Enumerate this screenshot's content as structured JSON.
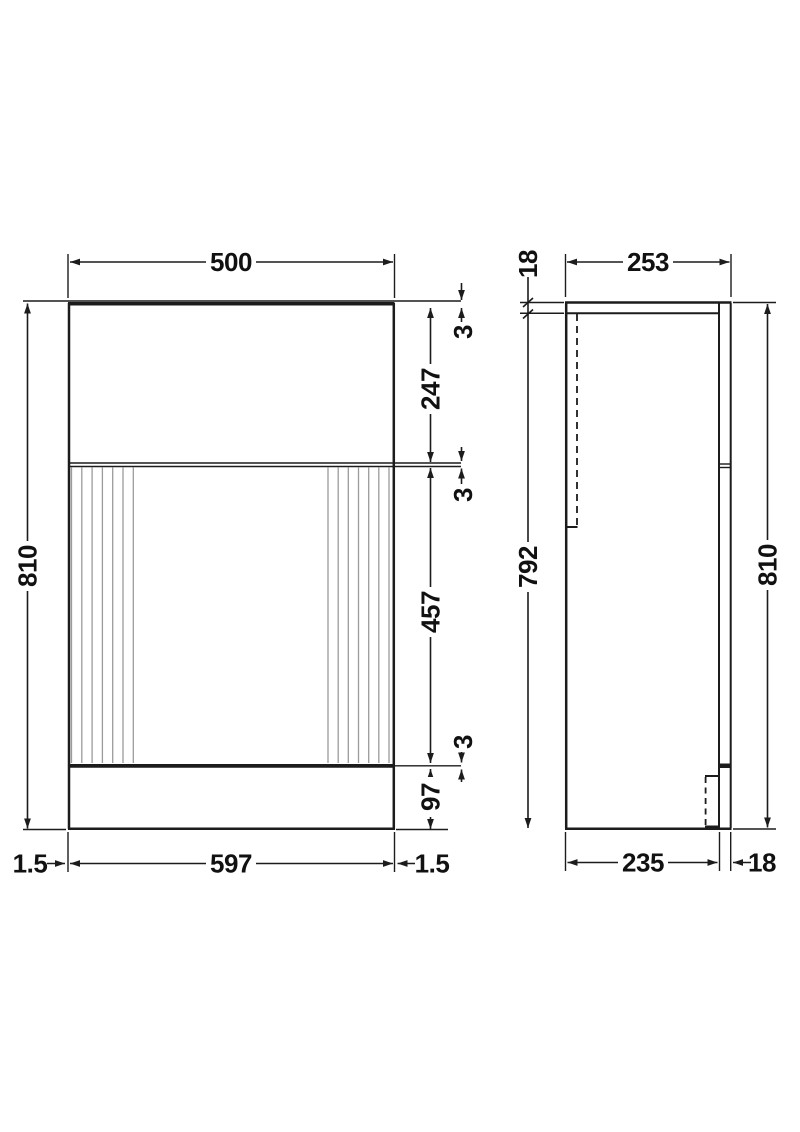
{
  "front_view": {
    "width_top": "500",
    "height_overall": "810",
    "top_trim": "3",
    "upper_panel": "247",
    "gap_upper": "3",
    "door_height": "457",
    "gap_lower": "3",
    "plinth_height": "97",
    "edge_left": "1.5",
    "width_bottom": "597",
    "edge_right": "1.5"
  },
  "side_view": {
    "top_thickness": "18",
    "depth_top": "253",
    "carcass_height": "792",
    "height_overall": "810",
    "depth_bottom": "235",
    "front_thickness": "18"
  },
  "colors": {
    "line": "#1c1c1c",
    "flute": "#9b9b9b",
    "background": "#ffffff"
  }
}
